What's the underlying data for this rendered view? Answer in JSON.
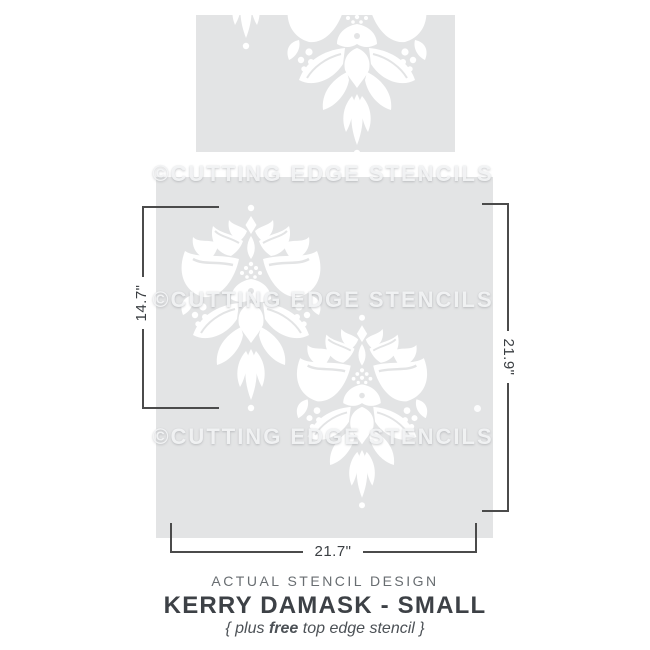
{
  "watermark": {
    "text": "©CUTTING EDGE STENCILS"
  },
  "dimensions": {
    "left_height": "14.7\"",
    "right_height": "21.9\"",
    "bottom_width": "21.7\""
  },
  "footer": {
    "eyebrow": "ACTUAL STENCIL DESIGN",
    "title": "KERRY DAMASK - SMALL",
    "subtitle_prefix": "{ plus ",
    "subtitle_bold": "free",
    "subtitle_suffix": " top edge stencil }"
  },
  "colors": {
    "panel_gray": "#e3e4e5",
    "dimension_line": "#4b4b4b",
    "title_text": "#3d4146",
    "stencil_cutout": "#ffffff"
  }
}
